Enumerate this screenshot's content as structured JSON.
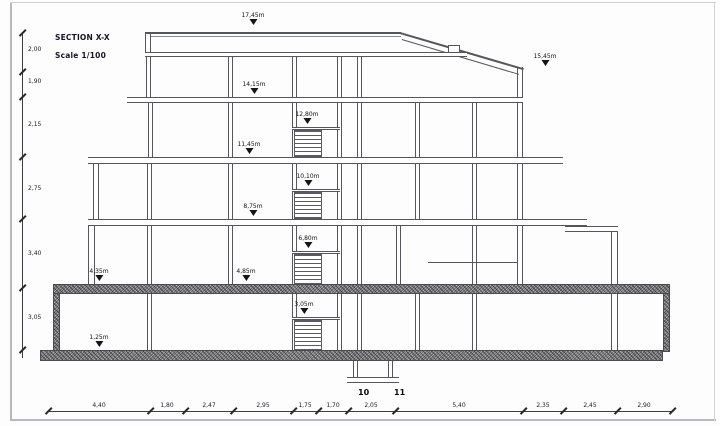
{
  "page": {
    "title_line1": "SECTION X-X",
    "title_line2": "Scale 1/100"
  },
  "grid_bubbles": {
    "left": "10",
    "right": "11"
  },
  "levels": {
    "parapet": "17,45m",
    "roof_right": "15,45m",
    "floor4": "14,15m",
    "landing43": "12,80m",
    "floor3": "11,45m",
    "landing32": "10,10m",
    "floor2": "8,75m",
    "landing2g": "6,80m",
    "ground": "4,85m",
    "grade": "4,35m",
    "landingb": "3,05m",
    "basement": "1,25m"
  },
  "dims_left": [
    "2,00",
    "1,90",
    "2,15",
    "2,75",
    "3,40",
    "3,05"
  ],
  "dims_bottom": [
    "4,40",
    "1,80",
    "2,47",
    "2,95",
    "1,75",
    "1,70",
    "2,05",
    "5,40",
    "2,35",
    "2,45",
    "2,90"
  ],
  "colors": {
    "line": "#55555c",
    "hatch_gray": "#a9a9ab",
    "text": "#1d1d22"
  }
}
